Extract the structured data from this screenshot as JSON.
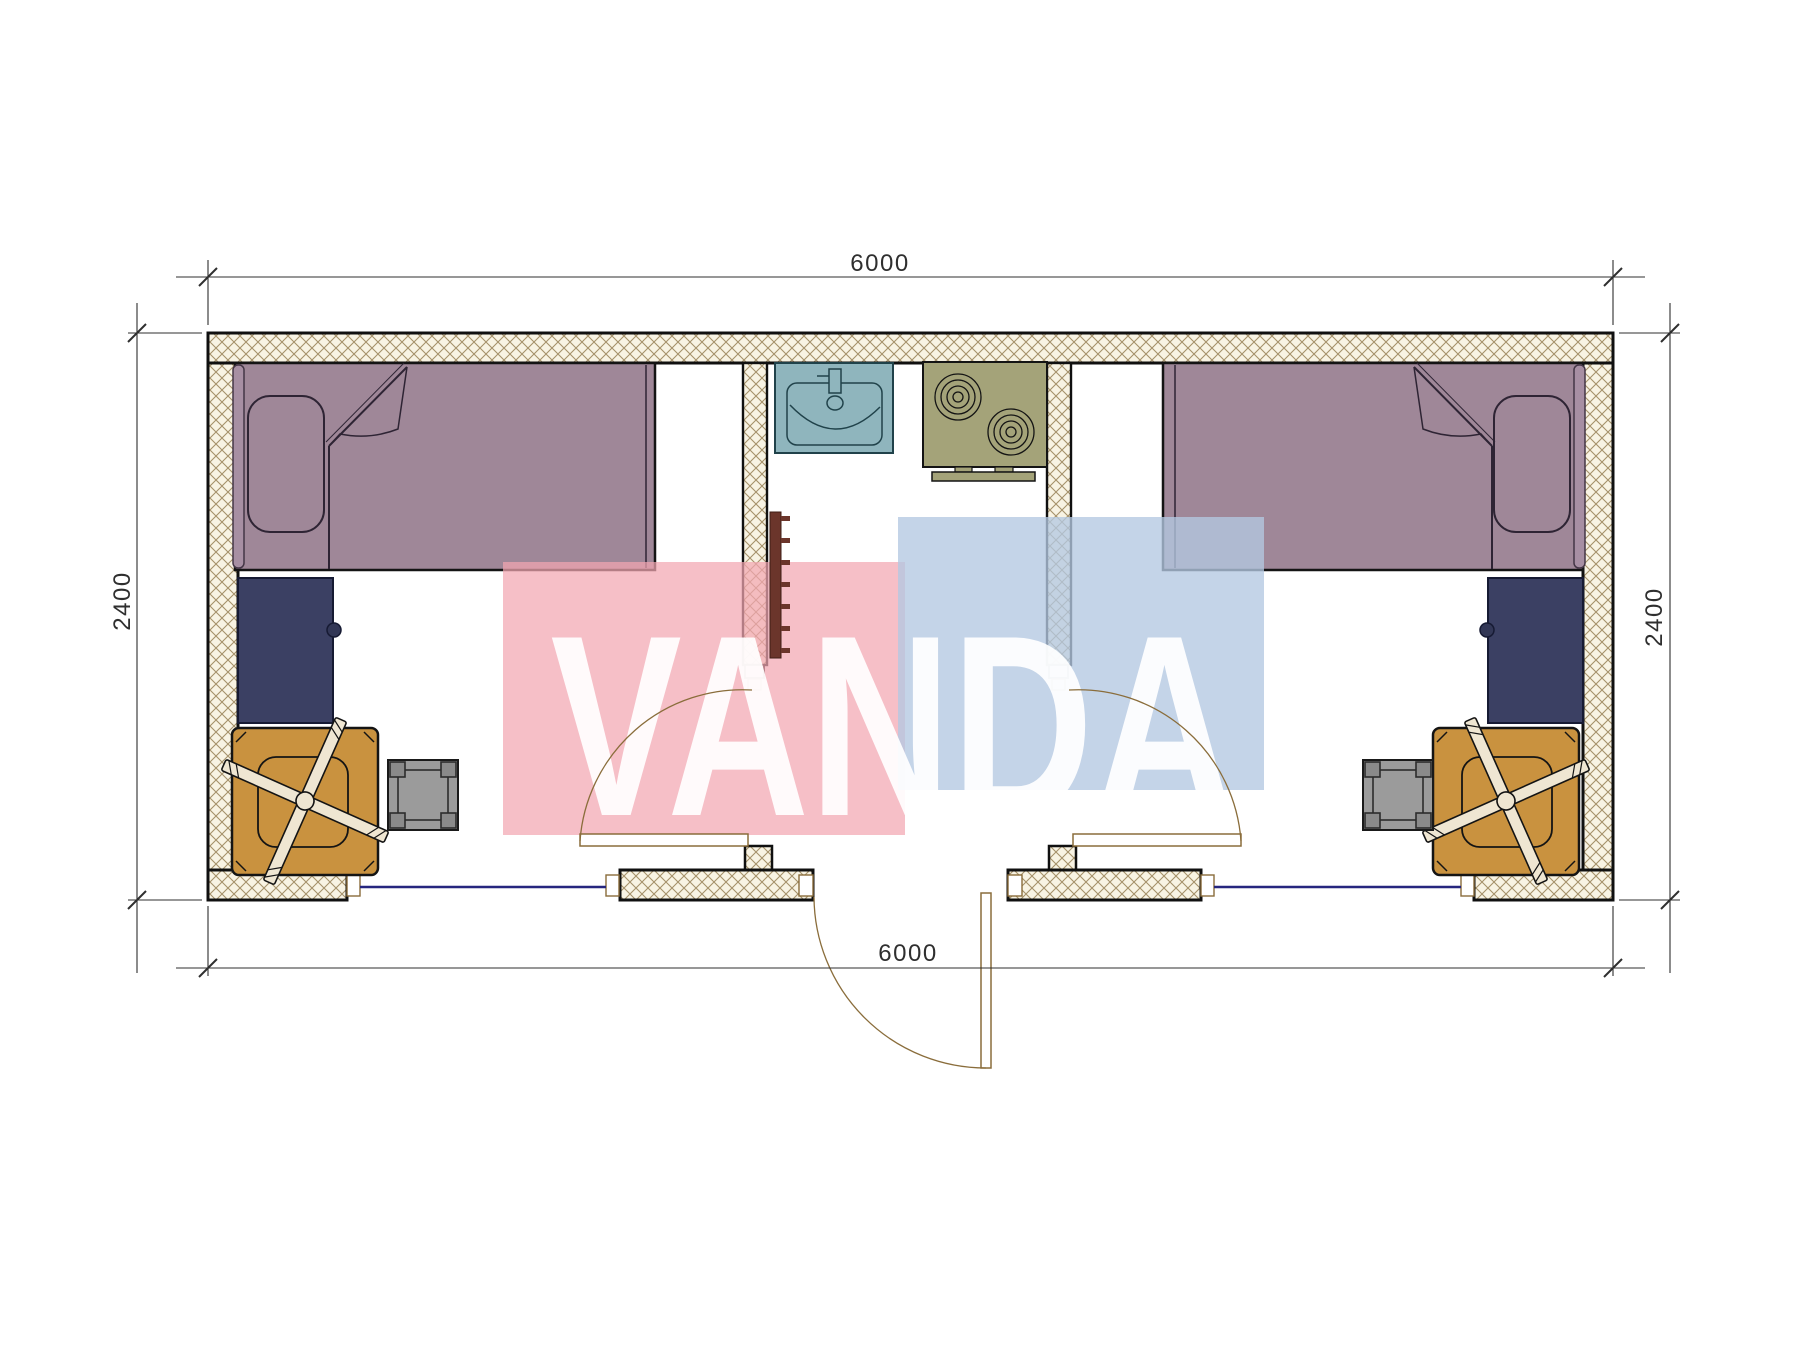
{
  "drawing": {
    "type": "architectural-floor-plan",
    "watermark": {
      "text": "VANDA",
      "pink_color": "#f3a6b2",
      "blue_color": "#b4c8e1",
      "letter_color": "#ffffff"
    },
    "dimensions": {
      "top": "6000",
      "bottom": "6000",
      "left": "2400",
      "right": "2400"
    },
    "colors": {
      "bed": "#9f8798",
      "desk": "#3b4063",
      "chair": "#c9923f",
      "stool": "#9b9b9b",
      "sink": "#8fb5bd",
      "stove": "#a4a379",
      "radiator": "#6b352b",
      "wall_fill": "#f8f3e3",
      "wall_hatch": "#a5916a",
      "wall_outline": "#101010",
      "window_line": "#26267e",
      "door_line": "#8a6d3b",
      "dimension_color": "#2f2f2f"
    },
    "elements": [
      "bed-left",
      "bed-right",
      "pillow-left",
      "pillow-right",
      "desk-left",
      "desk-right",
      "office-chair-left",
      "office-chair-right",
      "stool-left",
      "stool-right",
      "sink",
      "stove-two-burner",
      "radiator",
      "partition-left",
      "partition-right",
      "window-left",
      "window-right",
      "door-left-room",
      "door-right-room",
      "entrance-door"
    ]
  }
}
